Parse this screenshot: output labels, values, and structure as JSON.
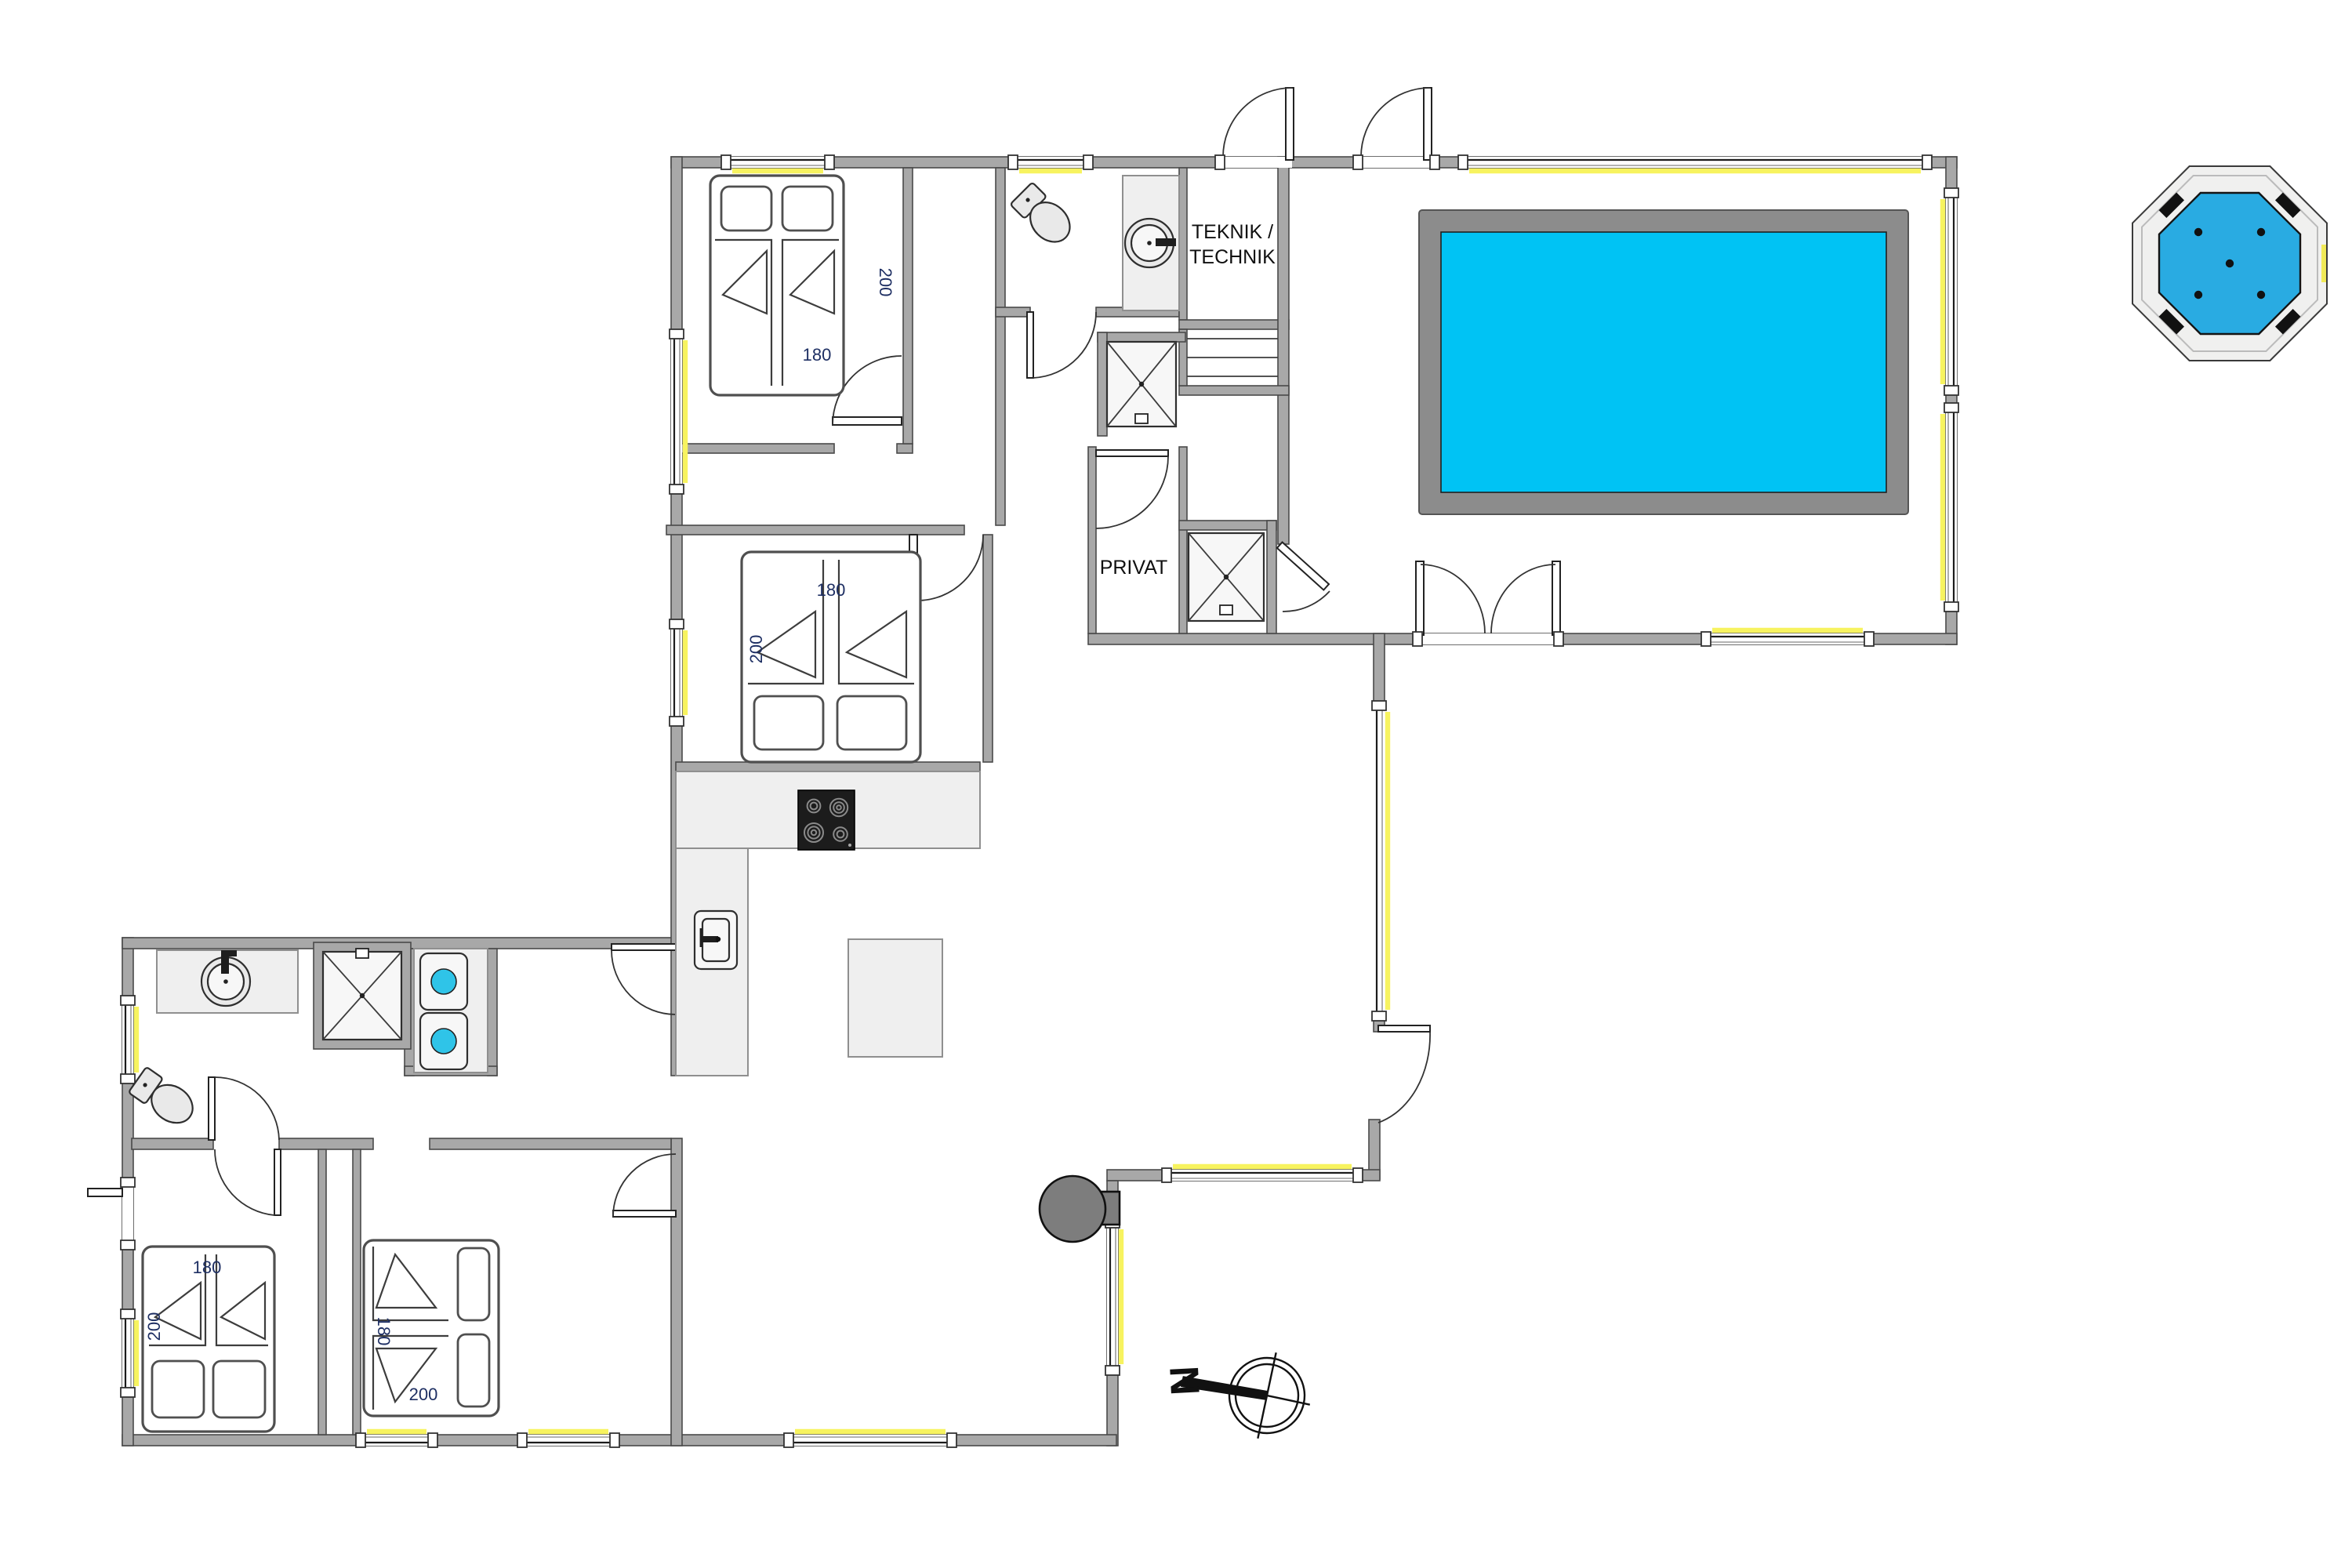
{
  "labels": {
    "teknik_line1": "TEKNIK /",
    "teknik_line2": "TECHNIK",
    "privat": "PRIVAT",
    "north": "N"
  },
  "beds": {
    "top_bedroom": {
      "width": "180",
      "length": "200"
    },
    "second_bedroom": {
      "width": "180",
      "length": "200"
    },
    "bottom_left_bedroom": {
      "width": "180",
      "length": "200"
    },
    "bottom_middle_bedroom": {
      "width": "180",
      "length": "200"
    }
  },
  "colors": {
    "wall": "#a8a8a8",
    "window_accent": "#f7f35f",
    "counter": "#efefef",
    "fixture": "#e9e9e9",
    "pool_water": "#00c3f4",
    "pool_border": "#8c8c8c",
    "hot_tub_water": "#29abe2",
    "washer_glass": "#2fc4e8",
    "fireplace": "#7d7d7d",
    "stove": "#1c1c1c",
    "label_color": "#1e2f63"
  }
}
